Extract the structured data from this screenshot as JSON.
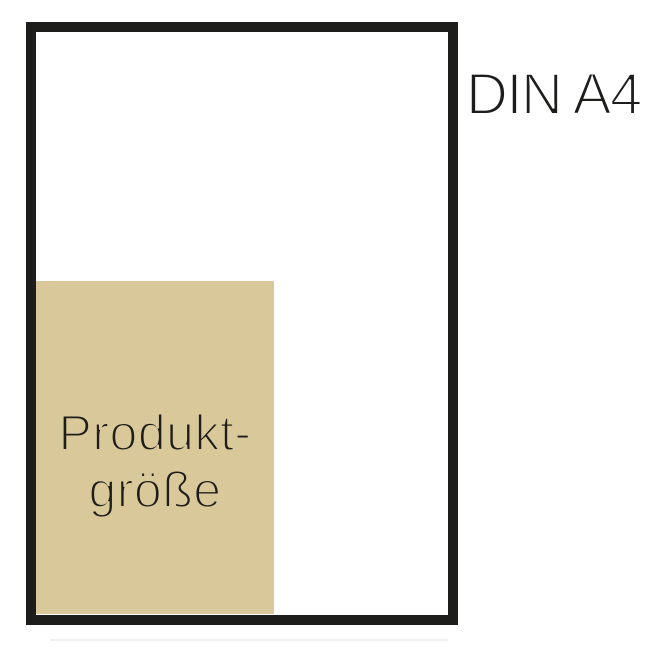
{
  "diagram": {
    "title": "Product size vs DIN A4 comparison",
    "din_label": "DIN A4",
    "product_label": {
      "line1": "Produkt-",
      "line2": "größe"
    },
    "colors": {
      "outline_black": "#1d1d1b",
      "product_fill_tan": "#d9c899",
      "sheet_fill": "#ffffff",
      "text": "#1d1d1b",
      "background": "#ffffff"
    }
  }
}
